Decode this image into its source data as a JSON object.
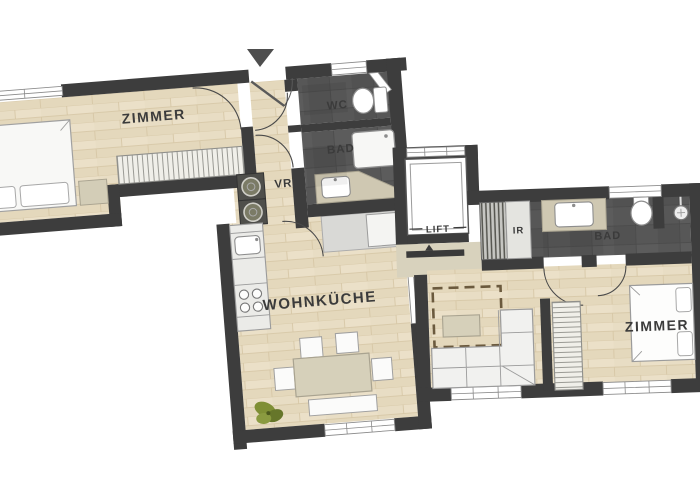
{
  "labels": {
    "left": {
      "bedroom": "ZIMMER",
      "toilet": "WC",
      "bathroom": "BAD",
      "hall": "VR",
      "kitchen": "WOHNKÜCHE"
    },
    "core": {
      "lift": "LIFT"
    },
    "right": {
      "utility": "IR",
      "bathroom": "BAD",
      "bedroom": "ZIMMER"
    }
  },
  "colors": {
    "wall": "#3d3d3d",
    "wood_floor": "#e8ddc4",
    "bath_floor": "#575757",
    "furniture_white": "#f4f4f2",
    "furniture_beige": "#d6d0ba",
    "landing_beige": "#d8d2bd",
    "plant_green": "#7f8f35",
    "background": "#ffffff"
  }
}
